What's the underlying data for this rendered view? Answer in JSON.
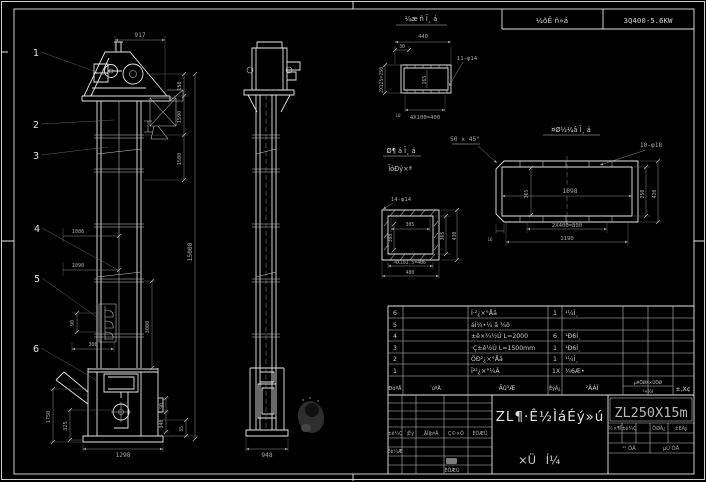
{
  "colors": {
    "background": "#000000",
    "line": "#e6e6e6",
    "dim_line": "#8f8f8f",
    "text": "#c8c8c8"
  },
  "header": {
    "gearbox": "¼õÊ ñ»á",
    "motor": "3Q400-5.6KW"
  },
  "balloons": {
    "b1": "1",
    "b2": "2",
    "b3": "3",
    "b4": "4",
    "b5": "5",
    "b6": "6"
  },
  "front": {
    "d917": "917",
    "d150": "150",
    "d1590": "1590",
    "d1500": "1500",
    "d15000": "15000",
    "d3000": "3000",
    "d1086": "1086",
    "d1090": "1090",
    "d90": "90",
    "d300": "300",
    "d1750": "1750",
    "d325": "325",
    "d1298": "1298",
    "d90b": "90",
    "d340": "340",
    "d35": "35"
  },
  "side": {
    "d948": "948"
  },
  "detail_top": {
    "title": "¼æ ñ Ī¸ á",
    "d440": "440",
    "d30": "30",
    "d10": "10",
    "holes": "11-φ14",
    "d400": "4X100=400",
    "d250": "2X125=250",
    "d265": "265"
  },
  "detail_flange": {
    "title1": "Ø¶ á Ī¸ á",
    "title2": "ĪóÐý×ª",
    "holes": "14-φ14",
    "d305": "305",
    "d308": "308",
    "d365": "365",
    "d430": "430",
    "d406": "4X101.5=406",
    "d480": "480"
  },
  "detail_side": {
    "title": "¤Ø½¼â Ī¸ á",
    "chamfer": "50 x 45°",
    "holes": "10-φ18",
    "d1098": "1098",
    "d365": "365",
    "d800": "2X400=800",
    "d1190": "1190",
    "d250": "250",
    "d420": "420",
    "d16": "16"
  },
  "bom": {
    "headers": {
      "ser": "ÐòºÅ",
      "code": "´úºÅ",
      "name": "Ãû³Æ",
      "qty": "ÊýÁ¿",
      "mat": "²ÄÁÏ",
      "wt1": "µ¥ÖØX×ÜÖØ",
      "wt2": "¹«½ï",
      "rem": "±,X¢"
    },
    "rows": [
      {
        "ser": "6",
        "name": "Í·²¿×°Åä",
        "qty": "1",
        "mat": "¹¼Í¸"
      },
      {
        "ser": "5",
        "name": "áÍ¼•¼ ã ¼ô",
        "qty": "",
        "mat": ""
      },
      {
        "ser": "4",
        "name": "±ê×¼½Ú L=2000",
        "qty": "6",
        "mat": "¹Ð6Í¸"
      },
      {
        "ser": "3",
        "name": "·Ç±ê½Ú L=1500mm",
        "qty": "1",
        "mat": "¹Ð6Í¸"
      },
      {
        "ser": "2",
        "name": "ÖÐ²¿×°Åä",
        "qty": "1",
        "mat": "¹¼Í¸"
      },
      {
        "ser": "1",
        "name": "Î²²¿×°¼Ä",
        "qty": "1X",
        "mat": "¼6Æ•"
      }
    ]
  },
  "titleblock": {
    "name": "ZL¶·Ê½ÌáÉý»ú",
    "model": "ZL250X15m",
    "type1": "×Ü",
    "type2": "Í¼",
    "rev": [
      "±ê¼Ç",
      "´¦Êý",
      "¸ÄÎļþºÅ",
      "Ç©×Ö",
      "ÈÕÆÚ"
    ],
    "sig": "Éè¼Æ",
    "date": "ÈÕÆÚ",
    "stage": [
      "½×¶Î",
      "±ê¼Ç",
      "ÖØÁ¿",
      "±ÈÀý"
    ],
    "sheet1": "¹² ÕÅ",
    "sheet2": "µÚ ÕÅ"
  }
}
